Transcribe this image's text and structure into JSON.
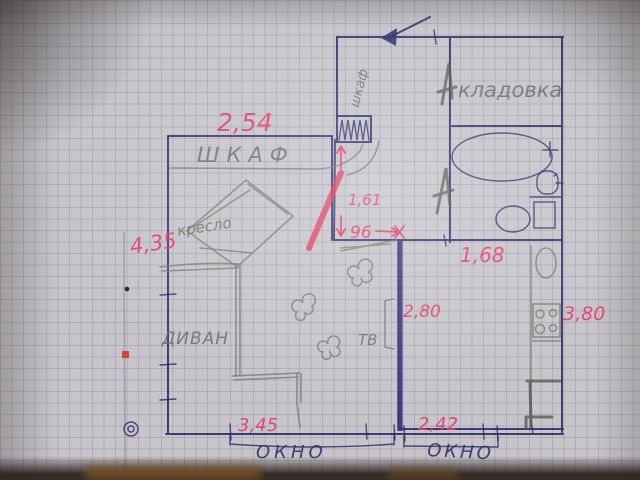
{
  "floorplan": {
    "labels": {
      "hall_closet": "шкаф",
      "storage": "кладовка",
      "wardrobe": "ШКАФ",
      "armchair": "кресло",
      "sofa": "ДИВАН",
      "tv": "ТВ",
      "window_left": "ОКНО",
      "window_right": "ОКНО"
    },
    "dimensions": {
      "wardrobe_wall": "2,54",
      "living_left": "4,35",
      "hall_height": "1,61",
      "doorway": "96",
      "bath_wall": "1,68",
      "kitchen_left": "2,80",
      "kitchen_right": "3,80",
      "window_left": "3,45",
      "window_right": "2,42"
    },
    "colors": {
      "ink": "#312F6B",
      "pencil": "#7C7870",
      "marker_red": "#E0426C",
      "wall_purple": "#3E3383",
      "highlight": "#E63059"
    }
  }
}
